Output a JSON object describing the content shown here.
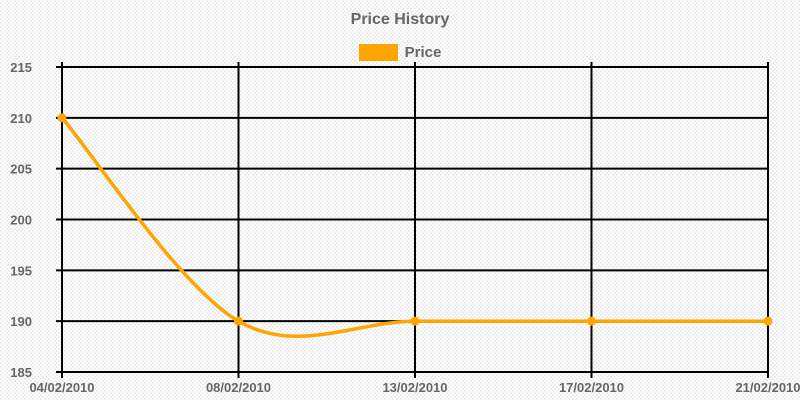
{
  "chart_data": {
    "type": "line",
    "title": "Price History",
    "categories": [
      "04/02/2010",
      "08/02/2010",
      "13/02/2010",
      "17/02/2010",
      "21/02/2010"
    ],
    "series": [
      {
        "name": "Price",
        "color": "#ffa500",
        "values": [
          210,
          190,
          190,
          190,
          190
        ]
      }
    ],
    "xlabel": "",
    "ylabel": "",
    "ylim": [
      185,
      215
    ],
    "yticks": [
      215,
      210,
      205,
      200,
      195,
      190,
      185
    ],
    "grid": true,
    "grid_color": "#000000",
    "text_color": "#666666",
    "legend_position": "top",
    "line_smoothing": true,
    "point_markers": true
  }
}
